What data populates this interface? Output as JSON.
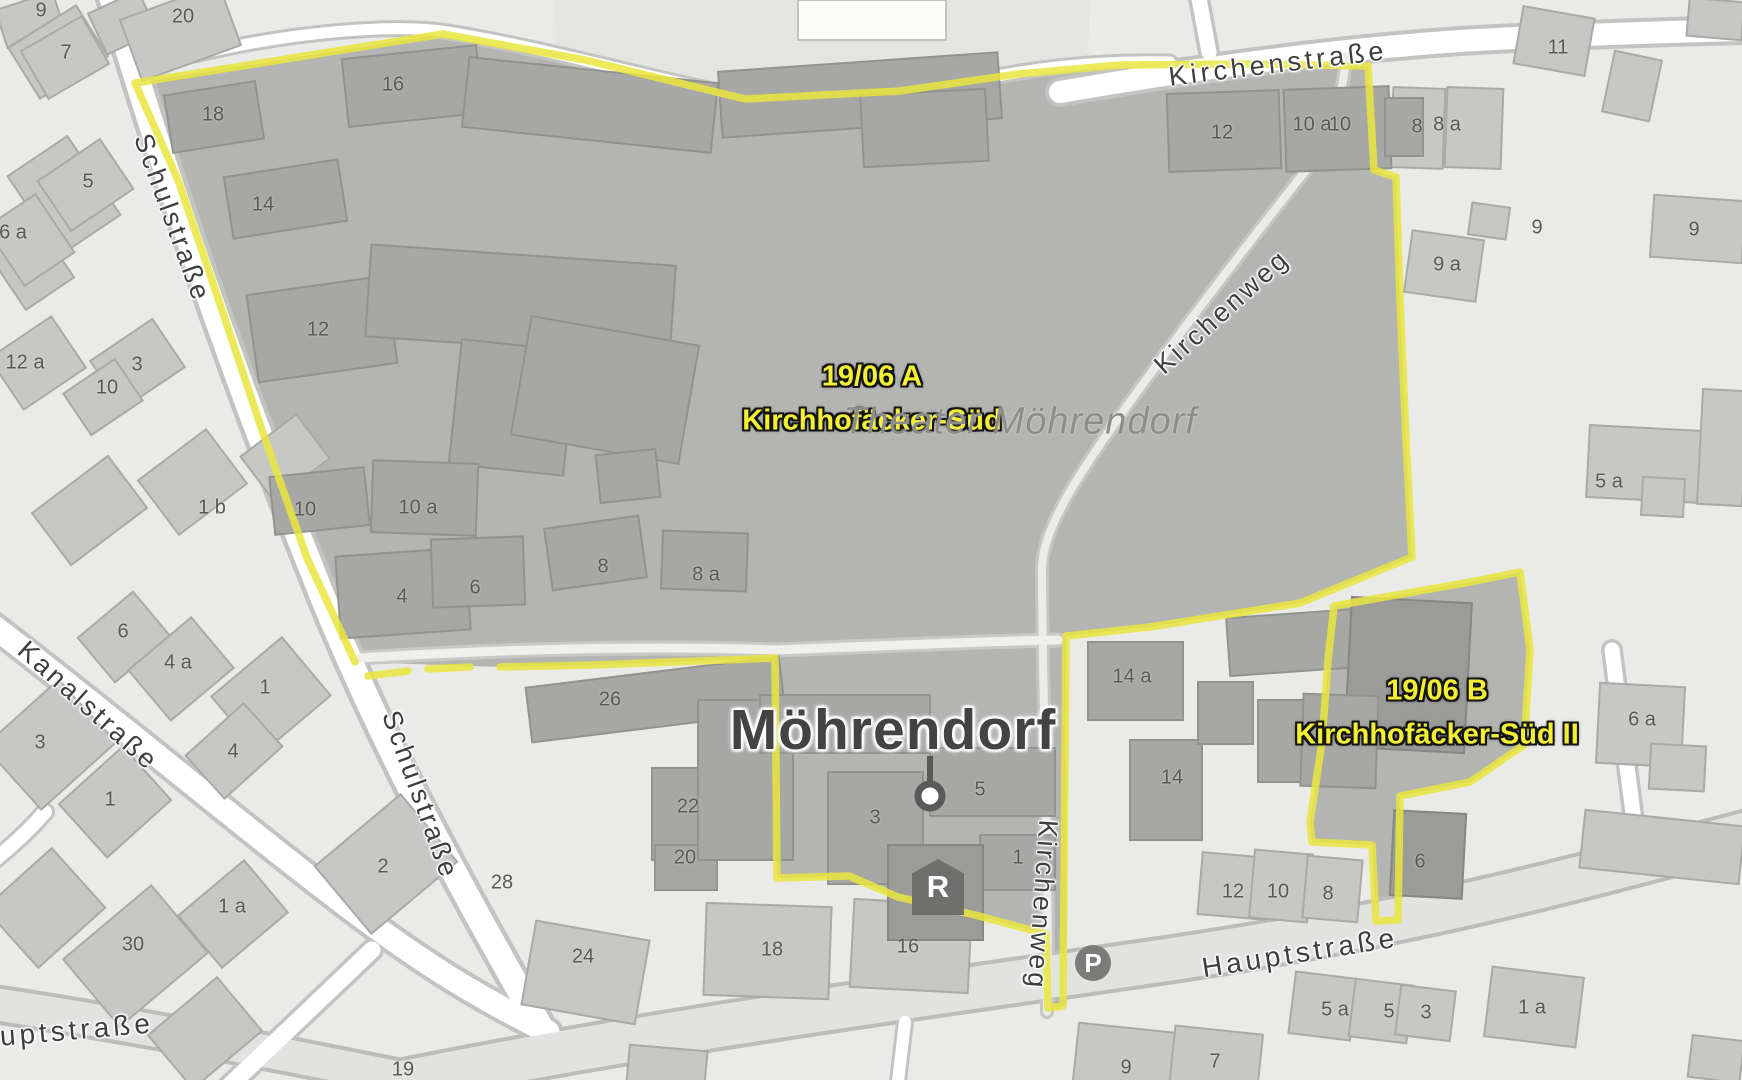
{
  "map": {
    "place_label": "Möhrendorf",
    "background_label": "Theater Möhrendorf",
    "colors": {
      "boundary_yellow": "#e9e63d",
      "area_label_text": "#f3ef35",
      "interior_fill": "#b4b4b2",
      "background_fill": "#eaeae8",
      "road_white": "#ffffff",
      "building_gray": "#c7c7c5"
    },
    "area_overlays": [
      {
        "code": "19/06 A",
        "name": "Kirchhofäcker-Süd",
        "x": 872,
        "y": 399
      },
      {
        "code": "19/06 B",
        "name": "Kirchhofäcker-Süd II",
        "x": 1437,
        "y": 713
      }
    ],
    "street_labels": [
      {
        "text": "Schulstraße",
        "x": 172,
        "y": 218,
        "rot": 70,
        "size": 27,
        "spacing": 3
      },
      {
        "text": "Schulstraße",
        "x": 420,
        "y": 795,
        "rot": 70,
        "size": 27,
        "spacing": 3
      },
      {
        "text": "Kanalstraße",
        "x": 88,
        "y": 706,
        "rot": 42,
        "size": 27,
        "spacing": 3
      },
      {
        "text": "Kirchenstraße",
        "x": 1278,
        "y": 64,
        "rot": -7,
        "size": 27,
        "spacing": 4
      },
      {
        "text": "Kirchenweg",
        "x": 1222,
        "y": 312,
        "rot": -42,
        "size": 27,
        "spacing": 3
      },
      {
        "text": "Kirchenweg",
        "x": 1042,
        "y": 905,
        "rot": 94,
        "size": 27,
        "spacing": 3
      },
      {
        "text": "Hauptstraße",
        "x": 1300,
        "y": 953,
        "rot": -9,
        "size": 28,
        "spacing": 4
      },
      {
        "text": "Hauptstraße",
        "x": 55,
        "y": 1032,
        "rot": -5,
        "size": 28,
        "spacing": 4
      }
    ],
    "house_numbers": [
      {
        "t": "9",
        "x": 41,
        "y": 11
      },
      {
        "t": "7",
        "x": 66,
        "y": 53
      },
      {
        "t": "20",
        "x": 183,
        "y": 17
      },
      {
        "t": "18",
        "x": 213,
        "y": 115
      },
      {
        "t": "16",
        "x": 393,
        "y": 85
      },
      {
        "t": "14",
        "x": 263,
        "y": 205
      },
      {
        "t": "5",
        "x": 88,
        "y": 182
      },
      {
        "t": "6 a",
        "x": 13,
        "y": 233
      },
      {
        "t": "12",
        "x": 318,
        "y": 330
      },
      {
        "t": "12 a",
        "x": 25,
        "y": 363
      },
      {
        "t": "3",
        "x": 137,
        "y": 365
      },
      {
        "t": "10",
        "x": 107,
        "y": 388
      },
      {
        "t": "1 b",
        "x": 212,
        "y": 508
      },
      {
        "t": "10",
        "x": 305,
        "y": 510
      },
      {
        "t": "10 a",
        "x": 418,
        "y": 508
      },
      {
        "t": "4",
        "x": 402,
        "y": 597
      },
      {
        "t": "6",
        "x": 475,
        "y": 588
      },
      {
        "t": "8",
        "x": 603,
        "y": 567
      },
      {
        "t": "8 a",
        "x": 706,
        "y": 575
      },
      {
        "t": "4 a",
        "x": 178,
        "y": 663
      },
      {
        "t": "1",
        "x": 265,
        "y": 688
      },
      {
        "t": "6",
        "x": 123,
        "y": 632
      },
      {
        "t": "3",
        "x": 40,
        "y": 743
      },
      {
        "t": "1",
        "x": 110,
        "y": 800
      },
      {
        "t": "4",
        "x": 233,
        "y": 752
      },
      {
        "t": "2",
        "x": 383,
        "y": 867
      },
      {
        "t": "1 a",
        "x": 232,
        "y": 907
      },
      {
        "t": "30",
        "x": 133,
        "y": 945
      },
      {
        "t": "26",
        "x": 610,
        "y": 700
      },
      {
        "t": "22",
        "x": 688,
        "y": 807
      },
      {
        "t": "20",
        "x": 685,
        "y": 858
      },
      {
        "t": "28",
        "x": 502,
        "y": 883
      },
      {
        "t": "24",
        "x": 583,
        "y": 957
      },
      {
        "t": "18",
        "x": 772,
        "y": 950
      },
      {
        "t": "16",
        "x": 908,
        "y": 947
      },
      {
        "t": "3",
        "x": 875,
        "y": 818
      },
      {
        "t": "5",
        "x": 980,
        "y": 790
      },
      {
        "t": "1",
        "x": 1018,
        "y": 858
      },
      {
        "t": "14 a",
        "x": 1132,
        "y": 677
      },
      {
        "t": "14",
        "x": 1172,
        "y": 778
      },
      {
        "t": "12",
        "x": 1222,
        "y": 133
      },
      {
        "t": "10 a",
        "x": 1312,
        "y": 125
      },
      {
        "t": "10",
        "x": 1340,
        "y": 125
      },
      {
        "t": "8",
        "x": 1417,
        "y": 127
      },
      {
        "t": "8 a",
        "x": 1447,
        "y": 125
      },
      {
        "t": "11",
        "x": 1558,
        "y": 48
      },
      {
        "t": "9",
        "x": 1537,
        "y": 228
      },
      {
        "t": "9 a",
        "x": 1447,
        "y": 265
      },
      {
        "t": "5 a",
        "x": 1609,
        "y": 482
      },
      {
        "t": "9",
        "x": 1694,
        "y": 230
      },
      {
        "t": "6 a",
        "x": 1642,
        "y": 720
      },
      {
        "t": "6",
        "x": 1420,
        "y": 862
      },
      {
        "t": "12",
        "x": 1233,
        "y": 892
      },
      {
        "t": "10",
        "x": 1278,
        "y": 892
      },
      {
        "t": "8",
        "x": 1328,
        "y": 894
      },
      {
        "t": "5 a",
        "x": 1335,
        "y": 1010
      },
      {
        "t": "5",
        "x": 1389,
        "y": 1012
      },
      {
        "t": "3",
        "x": 1426,
        "y": 1013
      },
      {
        "t": "1 a",
        "x": 1532,
        "y": 1008
      },
      {
        "t": "9",
        "x": 1126,
        "y": 1068
      },
      {
        "t": "7",
        "x": 1215,
        "y": 1062
      },
      {
        "t": "19",
        "x": 403,
        "y": 1070
      }
    ],
    "icons": [
      {
        "name": "town-center-icon",
        "glyph": "",
        "x": 930,
        "y": 796
      },
      {
        "name": "recycling-icon",
        "glyph": "R",
        "x": 938,
        "y": 887
      },
      {
        "name": "parking-icon",
        "glyph": "P",
        "x": 1093,
        "y": 963
      }
    ]
  }
}
